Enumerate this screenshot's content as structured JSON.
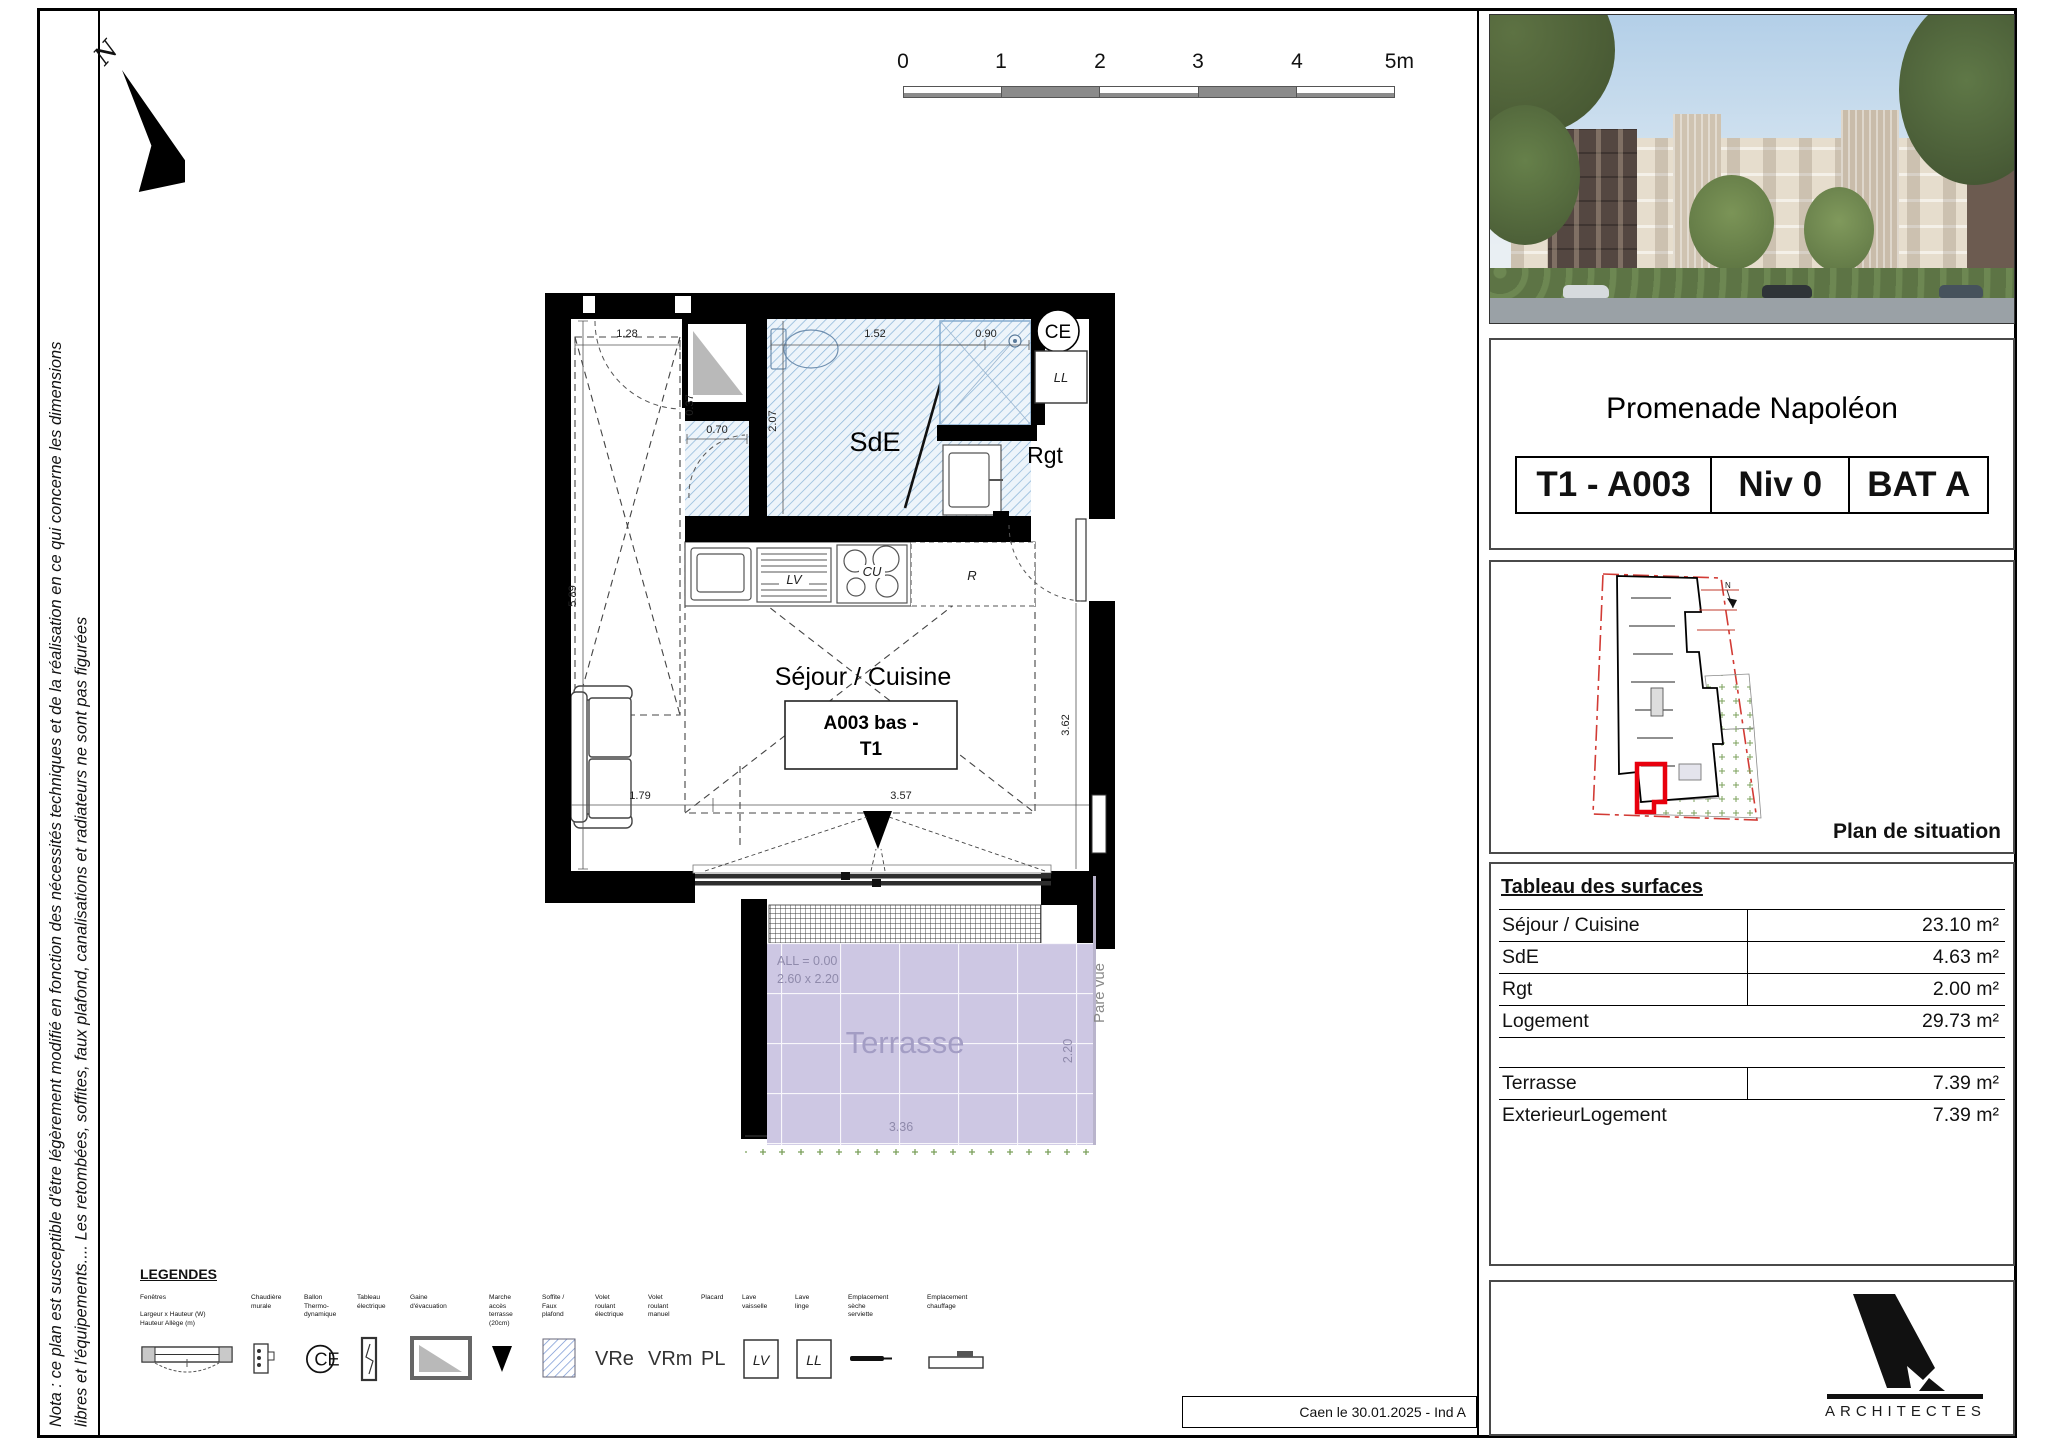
{
  "sheet": {
    "nota_line1": "Nota : ce plan est susceptible d'être légèrement modifié en fonction des nécessités techniques et de la réalisation en ce qui concerne les dimensions",
    "nota_line2": "libres et l'équipements.... Les retombées, soffites, faux plafond, canalisations et radiateurs ne sont pas figurées",
    "date_stamp": "Caen le 30.01.2025 - Ind A",
    "north_label": "N"
  },
  "scale": {
    "ticks": [
      "0",
      "1",
      "2",
      "3",
      "4"
    ],
    "end": "5m"
  },
  "plan": {
    "labels": {
      "sde": "SdE",
      "rgt": "Rgt",
      "sejour": "Séjour / Cuisine",
      "tag_line1": "A003 bas -",
      "tag_line2": "T1",
      "terrasse": "Terrasse",
      "gaine_tag": "A003"
    },
    "equip": {
      "ce": "CE",
      "ll": "LL",
      "lv": "LV",
      "cu": "CU",
      "r": "R"
    },
    "dims": {
      "entry": "1.28",
      "left": "5.89",
      "sde_w": "1.52",
      "sde_h": "2.07",
      "shower": "0.90",
      "wc_w": "0.70",
      "wc_d": "0.37",
      "right": "3.62",
      "bottom_l": "1.79",
      "bottom_r": "3.57"
    },
    "terrasse": {
      "level": "ALL = 0.00",
      "bay": "2.60 x 2.20",
      "width": "3.36",
      "depth": "2.20",
      "screen": "Pare vue"
    }
  },
  "legend": {
    "title": "LEGENDES",
    "items": [
      {
        "lines": [
          "Fenêtres",
          "Largeur x Hauteur (W)",
          "Hauteur Allège (m)"
        ]
      },
      {
        "lines": [
          "Chaudière",
          "murale"
        ]
      },
      {
        "lines": [
          "Ballon",
          "Thermo-",
          "dynamique"
        ]
      },
      {
        "lines": [
          "Tableau",
          "électrique"
        ]
      },
      {
        "lines": [
          "Gaine",
          "d'évacuation"
        ]
      },
      {
        "lines": [
          "Marche",
          "accès",
          "terrasse",
          "(20cm)"
        ]
      },
      {
        "lines": [
          "Soffite /",
          "Faux",
          "plafond"
        ]
      },
      {
        "lines": [
          "Volet",
          "roulant",
          "électrique"
        ],
        "symbol": "VRe"
      },
      {
        "lines": [
          "Volet",
          "roulant",
          "manuel"
        ],
        "symbol": "VRm"
      },
      {
        "lines": [
          "Placard"
        ],
        "symbol": "PL"
      },
      {
        "lines": [
          "Lave",
          "vaisselle"
        ],
        "symbol": "LV"
      },
      {
        "lines": [
          "Lave",
          "linge"
        ],
        "symbol": "LL"
      },
      {
        "lines": [
          "Emplacement",
          "sèche",
          "serviette"
        ]
      },
      {
        "lines": [
          "Emplacement",
          "chauffage"
        ]
      }
    ]
  },
  "right_panel": {
    "project_title": "Promenade Napoléon",
    "unit": {
      "type": "T1 - A003",
      "level": "Niv 0",
      "building": "BAT A"
    },
    "situation_caption": "Plan de situation",
    "surfaces": {
      "title": "Tableau des surfaces",
      "rows": [
        {
          "label": "Séjour / Cuisine",
          "value": "23.10 m²"
        },
        {
          "label": "SdE",
          "value": "4.63 m²"
        },
        {
          "label": "Rgt",
          "value": "2.00 m²"
        },
        {
          "label": "Logement",
          "value": "29.73 m²"
        },
        {
          "label": "Terrasse",
          "value": "7.39 m²"
        },
        {
          "label": "ExterieurLogement",
          "value": "7.39 m²"
        }
      ]
    },
    "logo_caption": "ARCHITECTES"
  },
  "colors": {
    "hatch_blue": "#8db6d9",
    "terrasse_bg": "#cdc7e3",
    "terrasse_text": "#a39dc4",
    "wall": "#000000",
    "site_red": "#e8000d",
    "green_dot": "#7ba05b"
  }
}
